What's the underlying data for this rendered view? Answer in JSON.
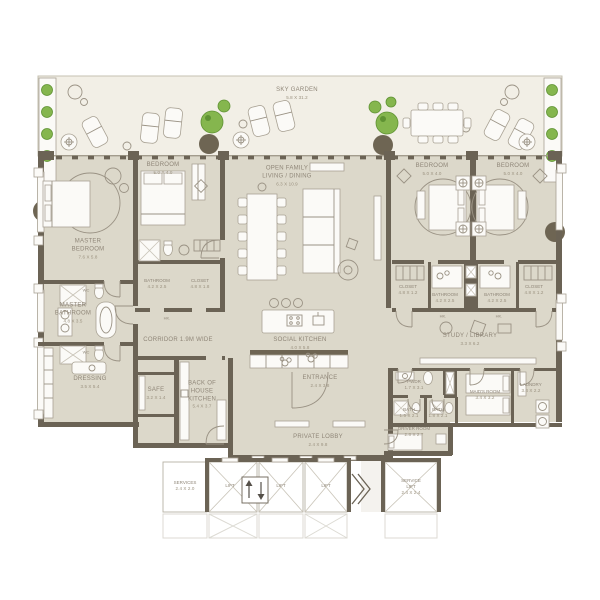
{
  "colors": {
    "wall": "#6b6355",
    "floor": "#dcd8ca",
    "sky_garden_floor": "#f2efe6",
    "fixture_white": "#fbfaf7",
    "plant_green": "#85b64e",
    "label_text": "#8f8678"
  },
  "rooms": {
    "sky_garden": {
      "l1": "SKY GARDEN",
      "dims": "5.8 X 31.2"
    },
    "master_bedroom": {
      "l1": "MASTER",
      "l2": "BEDROOM",
      "dims": "7.6 X 5.8"
    },
    "bedroom_2": {
      "l1": "BEDROOM",
      "dims": "5.0 X 4.0"
    },
    "open_family": {
      "l1": "OPEN FAMILY",
      "l2": "LIVING / DINING",
      "dims": "6.3 X 10.9"
    },
    "bedroom_3": {
      "l1": "BEDROOM",
      "dims": "5.0 X 4.0"
    },
    "bedroom_4": {
      "l1": "BEDROOM",
      "dims": "5.0 X 4.0"
    },
    "master_bathroom": {
      "l1": "MASTER",
      "l2": "BATHROOM",
      "dims": "4.8 X 3.5"
    },
    "bathroom_2": {
      "l1": "BATHROOM",
      "dims": "4.2 X 2.5"
    },
    "closet_2": {
      "l1": "CLOSET",
      "dims": "4.8 X 1.8"
    },
    "corridor": {
      "l1": "CORRIDOR 1.9M WIDE"
    },
    "social_kitchen": {
      "l1": "SOCIAL KITCHEN",
      "dims": "4.0 X 5.8"
    },
    "closet_3": {
      "l1": "CLOSET",
      "dims": "4.8 X 1.2"
    },
    "bathroom_3": {
      "l1": "BATHROOM",
      "dims": "4.2 X 2.5"
    },
    "bathroom_4": {
      "l1": "BATHROOM",
      "dims": "4.2 X 2.5"
    },
    "closet_4": {
      "l1": "CLOSET",
      "dims": "4.8 X 1.2"
    },
    "study_library": {
      "l1": "STUDY / LIBRARY",
      "dims": "3.3 X 6.2"
    },
    "dressing": {
      "l1": "DRESSING",
      "dims": "3.5 X 5.4"
    },
    "safe": {
      "l1": "SAFE",
      "dims": "3.2 X 1.4"
    },
    "boh_kitchen": {
      "l1": "BACK OF",
      "l2": "HOUSE",
      "l3": "KITCHEN",
      "dims": "5.4 X 3.7"
    },
    "entrance": {
      "l1": "ENTRANCE",
      "dims": "2.4 X 3.8"
    },
    "private_lobby": {
      "l1": "PRIVATE LOBBY",
      "dims": "2.4 X 9.8"
    },
    "pwdr": {
      "l1": "PWDR",
      "dims": "1.7 X 3.1"
    },
    "maids_room": {
      "l1": "MAID'S ROOM",
      "dims": "3.4 X 3.2"
    },
    "laundry": {
      "l1": "LAUNDRY",
      "dims": "3.4 X 2.2"
    },
    "bath_1": {
      "l1": "BATH",
      "dims": "1.5 X 2.1"
    },
    "bath_2": {
      "l1": "BATH",
      "dims": "1.8 X 2.1"
    },
    "driver_room": {
      "l1": "DRIVER ROOM",
      "dims": "2.8 X 2.7"
    },
    "services": {
      "l1": "SERVICES",
      "dims": "2.4 X 2.0"
    },
    "lift_1": {
      "l1": "LIFT"
    },
    "lift_2": {
      "l1": "LIFT"
    },
    "lift_3": {
      "l1": "LIFT"
    },
    "service_lift": {
      "l1": "SERVICE",
      "l2": "LIFT",
      "dims": "2.4 X 2.4"
    },
    "wc_a": {
      "l1": "WC"
    },
    "wc_b": {
      "l1": "WC"
    },
    "hk_a": {
      "l1": "HK."
    },
    "hk_b": {
      "l1": "HK."
    },
    "hk_c": {
      "l1": "HK."
    }
  }
}
